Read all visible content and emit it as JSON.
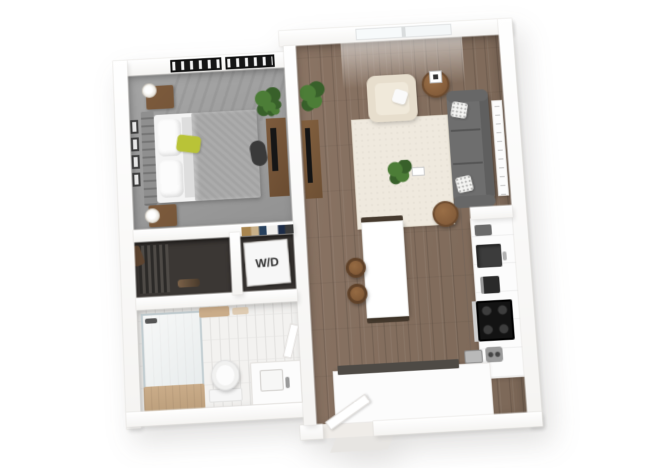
{
  "floorplan": {
    "wd_label": "W/D",
    "colors": {
      "background": "#ffffff",
      "wall_edge": "#e4e2df",
      "carpet": "#9c9c9c",
      "wood_floor": "#8a7464",
      "wood_floor_dark": "#7c6858",
      "rug": "#efe9de",
      "tile": "#f3f2f0",
      "tile_line": "#e2e1df",
      "closet_dark": "#3b3734",
      "sofa": "#6e6e6e",
      "sofa_dark": "#5f5f5f",
      "armchair": "#e7decd",
      "accent_pillow": "#b9c337",
      "plant_green": "#4c7d37",
      "plant_green_dark": "#38602a",
      "wood_furniture": "#77573a",
      "wood_light": "#caac89",
      "appliance_black": "#131313",
      "counter_white": "#fcfcfc",
      "comforter": "#a3a3a3",
      "headboard": "#8f8f8f"
    }
  }
}
